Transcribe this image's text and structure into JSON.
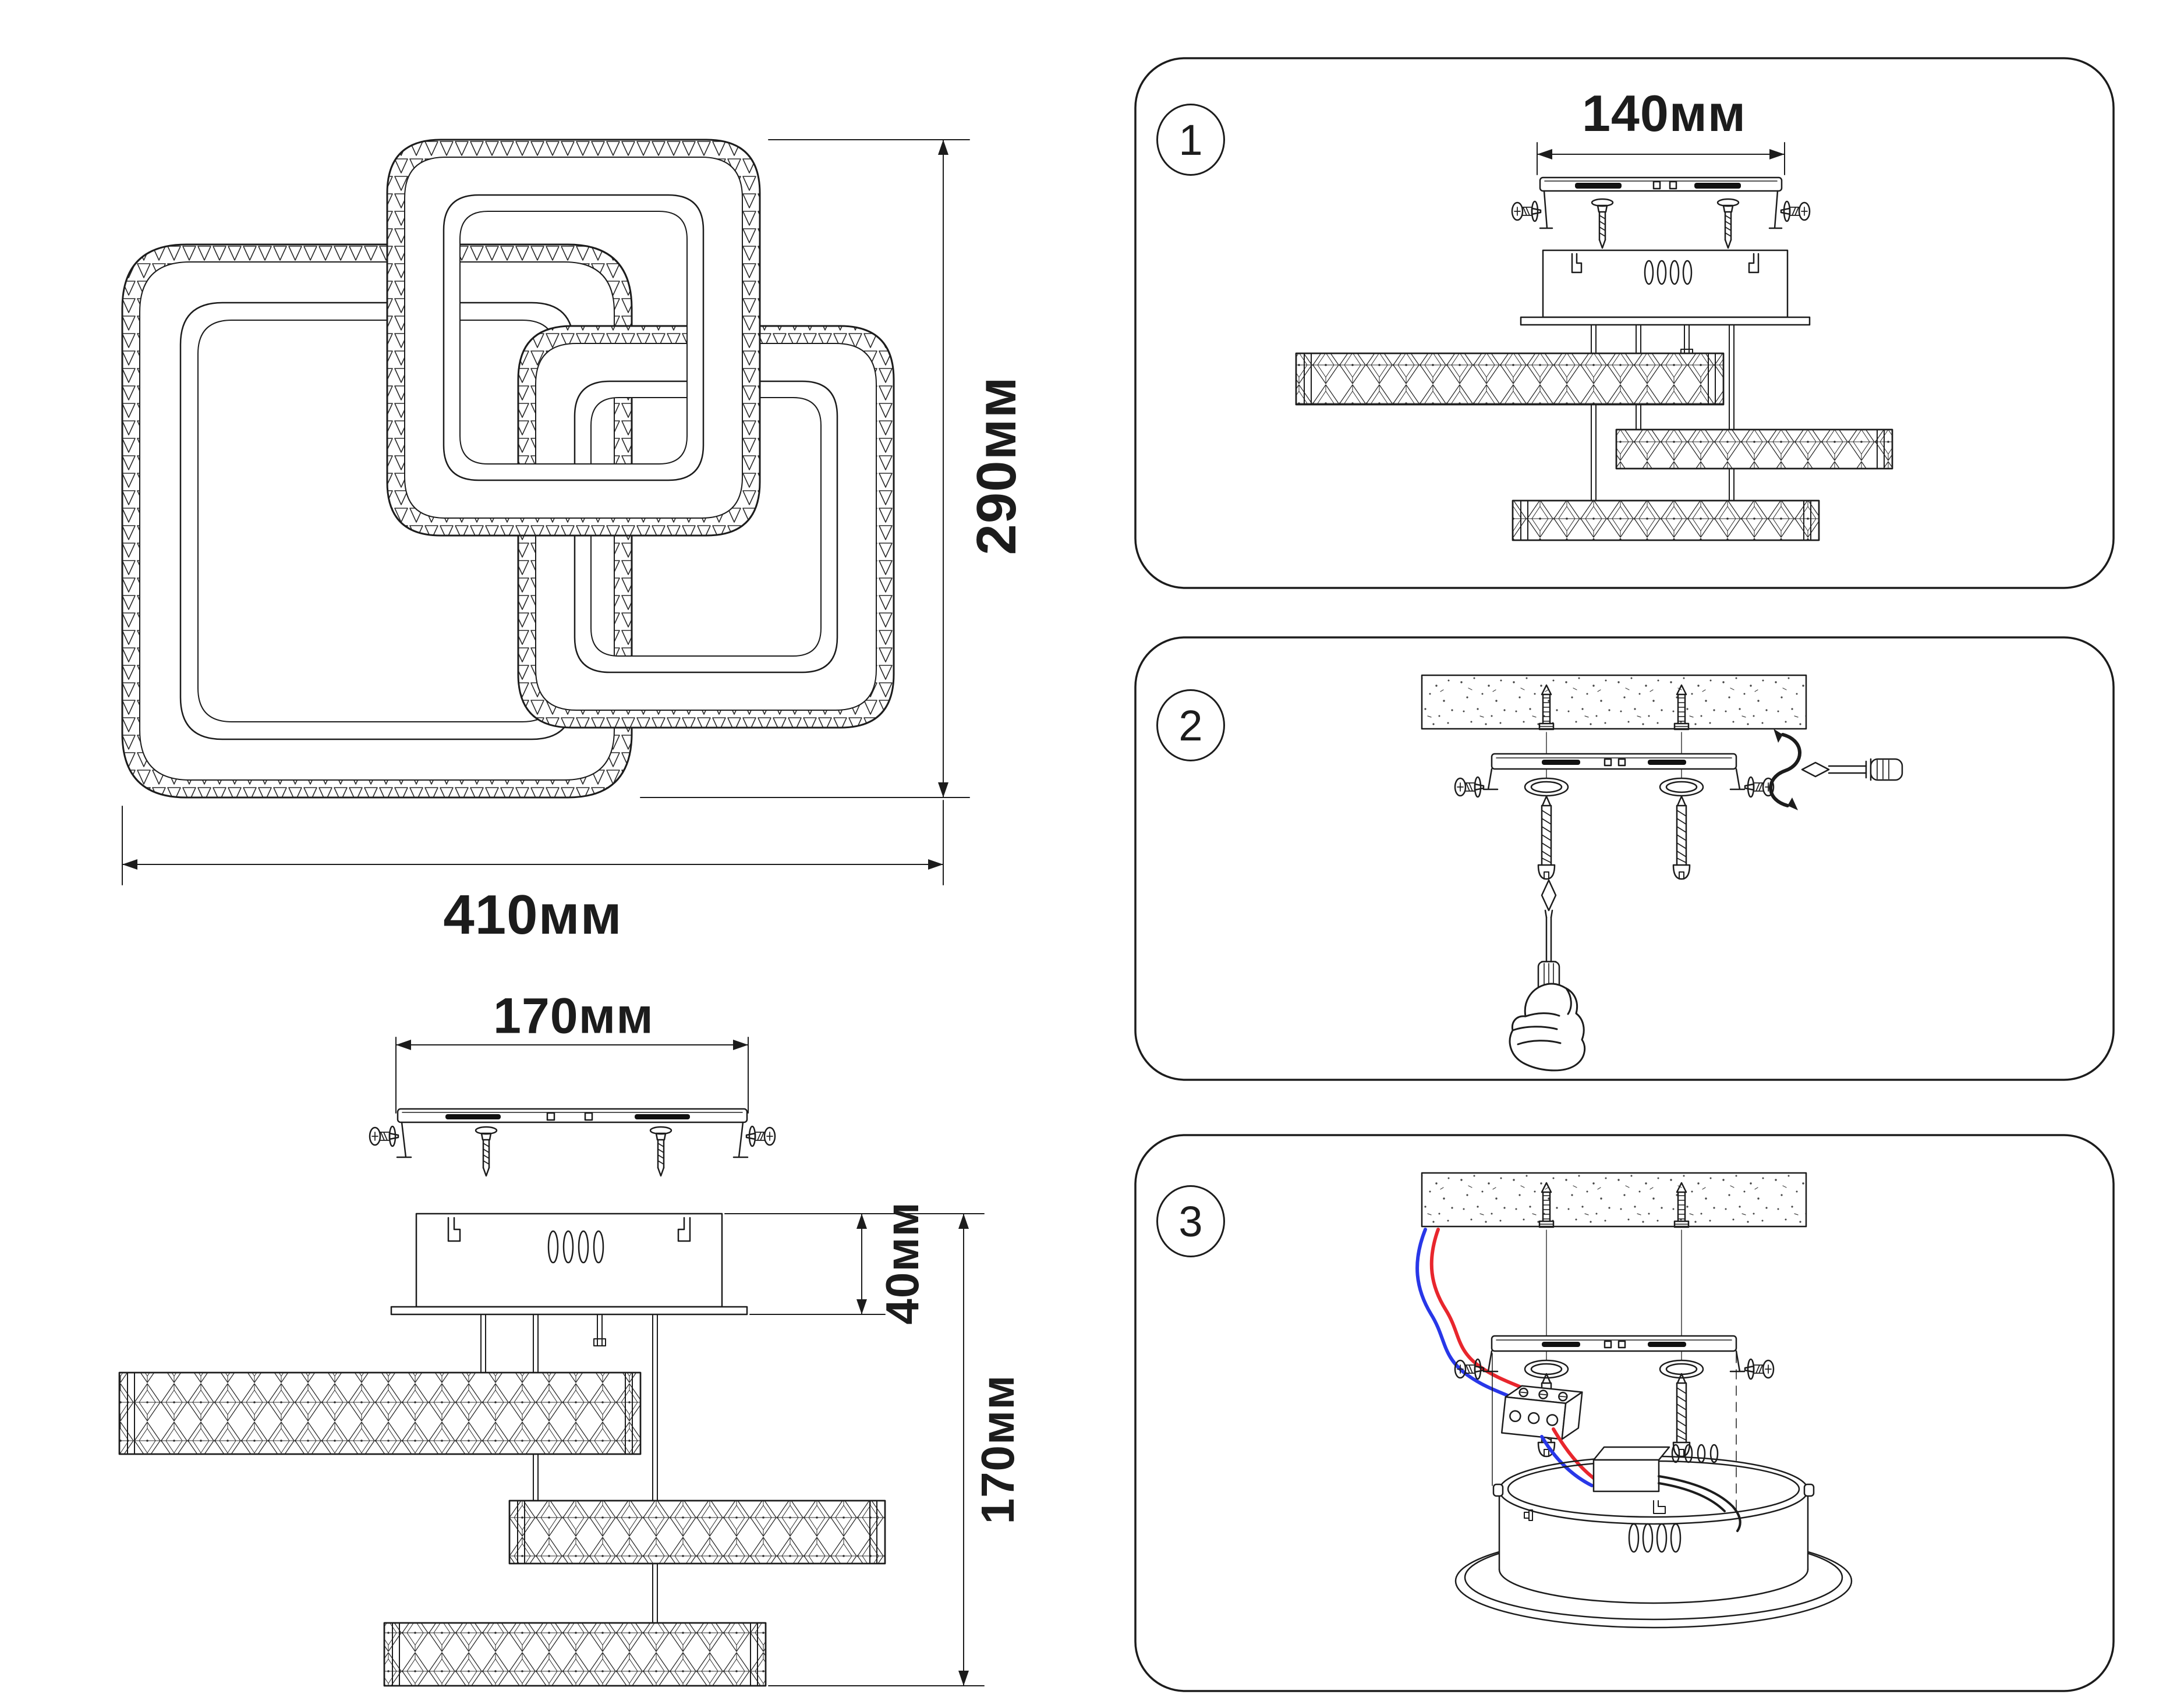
{
  "page": {
    "background": "#ffffff",
    "description": "Installation instruction sheet for LED ceiling chandelier"
  },
  "top_view": {
    "width_label": "410мм",
    "height_label": "290мм"
  },
  "side_view": {
    "bracket_width_label": "170мм",
    "canopy_height_label": "40мм",
    "fixture_height_label": "170мм"
  },
  "steps": [
    {
      "number": "1",
      "bracket_width_label": "140мм"
    },
    {
      "number": "2"
    },
    {
      "number": "3"
    }
  ],
  "colors": {
    "line": "#1c1c1c",
    "wire_red": "#e8262d",
    "wire_blue": "#2837e8"
  }
}
